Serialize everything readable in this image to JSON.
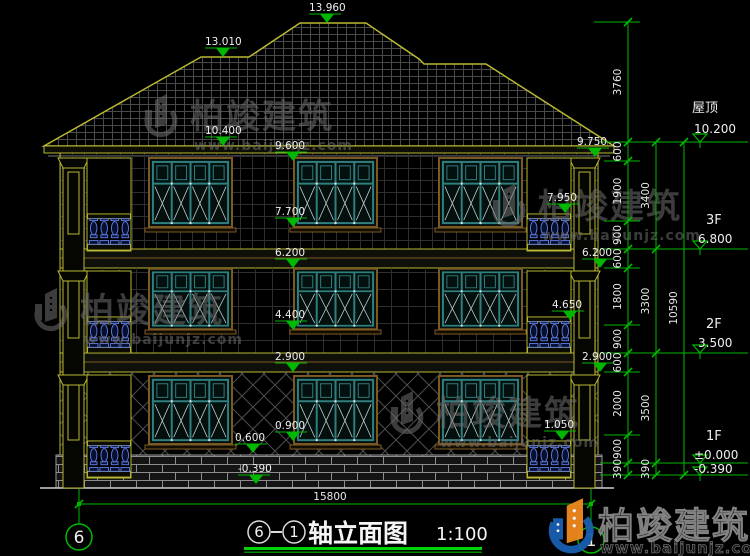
{
  "drawing": {
    "title": {
      "axis_from": "6",
      "axis_to": "1",
      "name": "轴立面图",
      "scale": "1:100"
    },
    "axis_bubbles": {
      "left": "6",
      "right": "1"
    },
    "bottom_dim": "15800",
    "markers": [
      {
        "id": "peak",
        "label": "13.960"
      },
      {
        "id": "ridge",
        "label": "13.010"
      },
      {
        "id": "m10400",
        "label": "10.400"
      },
      {
        "id": "m9600",
        "label": "9.600"
      },
      {
        "id": "m7700",
        "label": "7.700"
      },
      {
        "id": "m9750",
        "label": "9.750"
      },
      {
        "id": "m7950",
        "label": "7.950"
      },
      {
        "id": "m6200L",
        "label": "6.200"
      },
      {
        "id": "m6200R",
        "label": "6.200"
      },
      {
        "id": "m4400",
        "label": "4.400"
      },
      {
        "id": "m4650",
        "label": "4.650"
      },
      {
        "id": "m2900L",
        "label": "2.900"
      },
      {
        "id": "m2900R",
        "label": "2.900"
      },
      {
        "id": "m0900",
        "label": "0.900"
      },
      {
        "id": "m0600",
        "label": "0.600"
      },
      {
        "id": "m1050",
        "label": "1.050"
      },
      {
        "id": "mNeg390",
        "label": "-0.390"
      }
    ],
    "right_panel": {
      "roof_label": "屋顶",
      "roof_elev": "10.200",
      "f3_label": "3F",
      "f3_elev": "6.800",
      "f2_label": "2F",
      "f2_elev": "3.500",
      "f1_label": "1F",
      "f1_elev": "±0.000",
      "f1_below": "-0.390"
    },
    "dims": {
      "inner": [
        "600",
        "1900",
        "900",
        "600",
        "1800",
        "900",
        "600",
        "2000",
        "900",
        "390"
      ],
      "mid": [
        "3400",
        "3300",
        "3500",
        "390"
      ],
      "outer": [
        "3760",
        "10590"
      ]
    },
    "watermark": {
      "brand": "柏竣建筑",
      "url": "www.baijunjz.com"
    },
    "colors": {
      "line_green": "#00b800",
      "cad_yellow": "#b9b932",
      "window_teal": "#2e7f7f",
      "logo_blue": "#1a5fb0",
      "logo_orange": "#f08a1e"
    }
  }
}
